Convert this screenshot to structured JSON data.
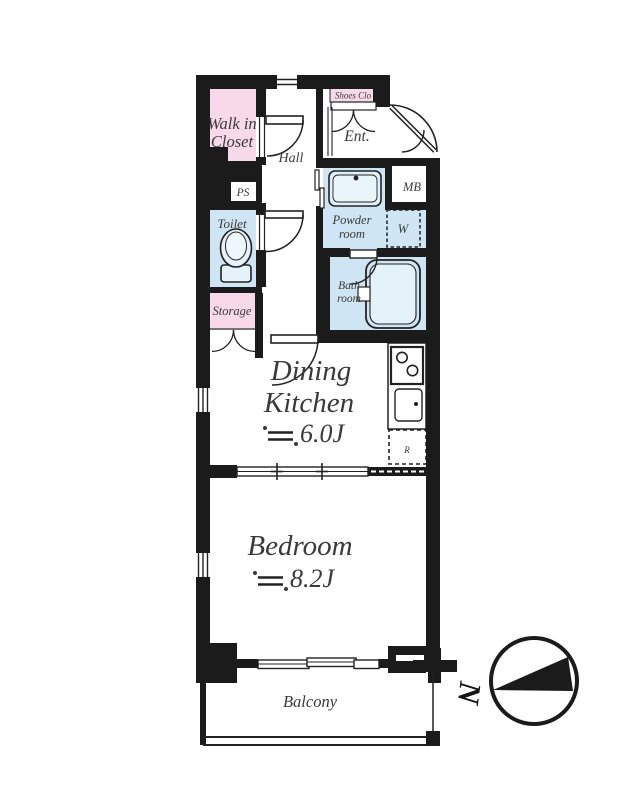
{
  "colors": {
    "wall": "#1b1b1b",
    "room_pink": "#f8d9e9",
    "room_blue": "#cfe5f3",
    "fixture_light": "#e6f2fa",
    "text": "#3a3a3a"
  },
  "rooms": {
    "walk_in_closet": {
      "line1": "Walk in",
      "line2": "Closet"
    },
    "hall": {
      "label": "Hall"
    },
    "shoes_closet": {
      "label": "Shoes Clo"
    },
    "entrance": {
      "label": "Ent."
    },
    "meter_box": {
      "label": "MB"
    },
    "pipe_space": {
      "label": "PS"
    },
    "toilet": {
      "label": "Toilet"
    },
    "powder_room": {
      "line1": "Powder",
      "line2": "room"
    },
    "washer": {
      "label": "W"
    },
    "bath_room": {
      "line1": "Bath",
      "line2": "room"
    },
    "storage": {
      "label": "Storage"
    },
    "dining_kitchen": {
      "line1": "Dining",
      "line2": "Kitchen",
      "approx_symbol": "≒",
      "area": "6.0J"
    },
    "refrigerator": {
      "label": "R"
    },
    "bedroom": {
      "label": "Bedroom",
      "approx_symbol": "≒",
      "area": "8.2J"
    },
    "balcony": {
      "label": "Balcony"
    }
  },
  "compass": {
    "north_label": "N"
  }
}
